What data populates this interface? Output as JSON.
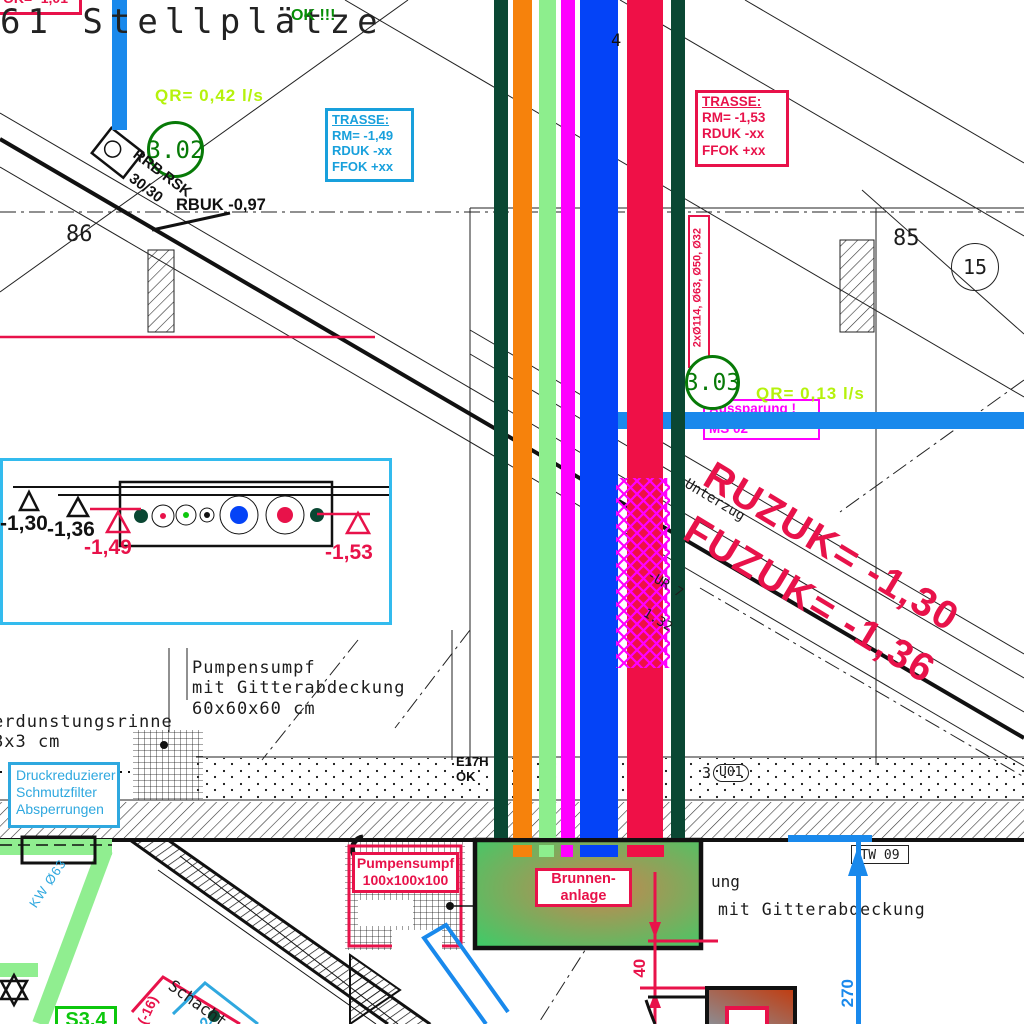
{
  "colors": {
    "crimson": "#E8124A",
    "band_red": "#EF1047",
    "band_blue": "#0443F7",
    "band_orange": "#F6820C",
    "band_light_green": "#8DEE8D",
    "band_magenta": "#FF00FF",
    "band_dark_green": "#0A4733",
    "pipe_blue": "#1989EC",
    "pipe_light_green": "#90EE90",
    "cyan_box": "#18A0DC",
    "detail_border": "#33BBEE",
    "yellow_green": "#B5F20C",
    "node_green": "#077A07",
    "ok_green": "#068F06",
    "lime_green": "#0DC70D"
  },
  "labels": {
    "corner_note": "OK= -1,01",
    "stellplaetze": "61 Stellplätze",
    "ok_note": "OK !!!",
    "qr_top": "QR= 0,42 l/s",
    "node_302": "3.02",
    "drain_line1": "RRB RSK",
    "drain_line2": "30/30",
    "rbuk": "RBUK -0,97",
    "parcel_left": "86",
    "parcel_right": "85",
    "node_15": "15",
    "trasse_cyan": {
      "title": "TRASSE:",
      "rm": "RM= -1,49",
      "rduk": "RDUK -xx",
      "ffok": "FFOK +xx"
    },
    "trasse_red": {
      "title": "TRASSE:",
      "rm": "RM= -1,53",
      "rduk": "RDUK -xx",
      "ffok": "FFOK +xx"
    },
    "pipe_callout": "2xØ114, Ø63, Ø50, Ø32",
    "node_303": "3.03",
    "qr_mid": "QR= 0,13 l/s",
    "aussparung_line1": "Aussparung !",
    "aussparung_line2": "MS 02",
    "ruzuk": "RUZUK= -1,30",
    "fuzuk": "FUZUK= -1,36",
    "unterzug": "Unterzug",
    "ur7": "-UR 7",
    "ur7b": "1.32",
    "riser_num": "4",
    "level_130": "-1,30",
    "level_136": "-1,36",
    "level_149": "-1,49",
    "level_153": "-1,53",
    "sump60_line1": "Pumpensumpf",
    "sump60_line2": "mit Gitterabdeckung",
    "sump60_line3": "60x60x60 cm",
    "rinne_line1": "erdunstungsrinne",
    "rinne_line2": "8x3 cm",
    "armaturen_line1": "Druckreduzierer",
    "armaturen_line2": "Schmutzfilter",
    "armaturen_line3": "Absperrungen",
    "e17h": "E17H",
    "ok_small": "OK",
    "room_prefix": "3",
    "room_id": "U01",
    "sump100_line1": "Pumpensumpf",
    "sump100_line2": "100x100x100",
    "brunnen_line1": "Brunnen-",
    "brunnen_line2": "anlage",
    "ung_fragment": "ung",
    "gitter_fragment": "mit Gitterabdeckung",
    "tw09": "TW 09",
    "dim_40": "40",
    "dim_270": "270",
    "kw63": "KW Ø63",
    "s34": "S3.4",
    "schacht": "Schacht",
    "minus16": "(-16)",
    "two": "2"
  }
}
